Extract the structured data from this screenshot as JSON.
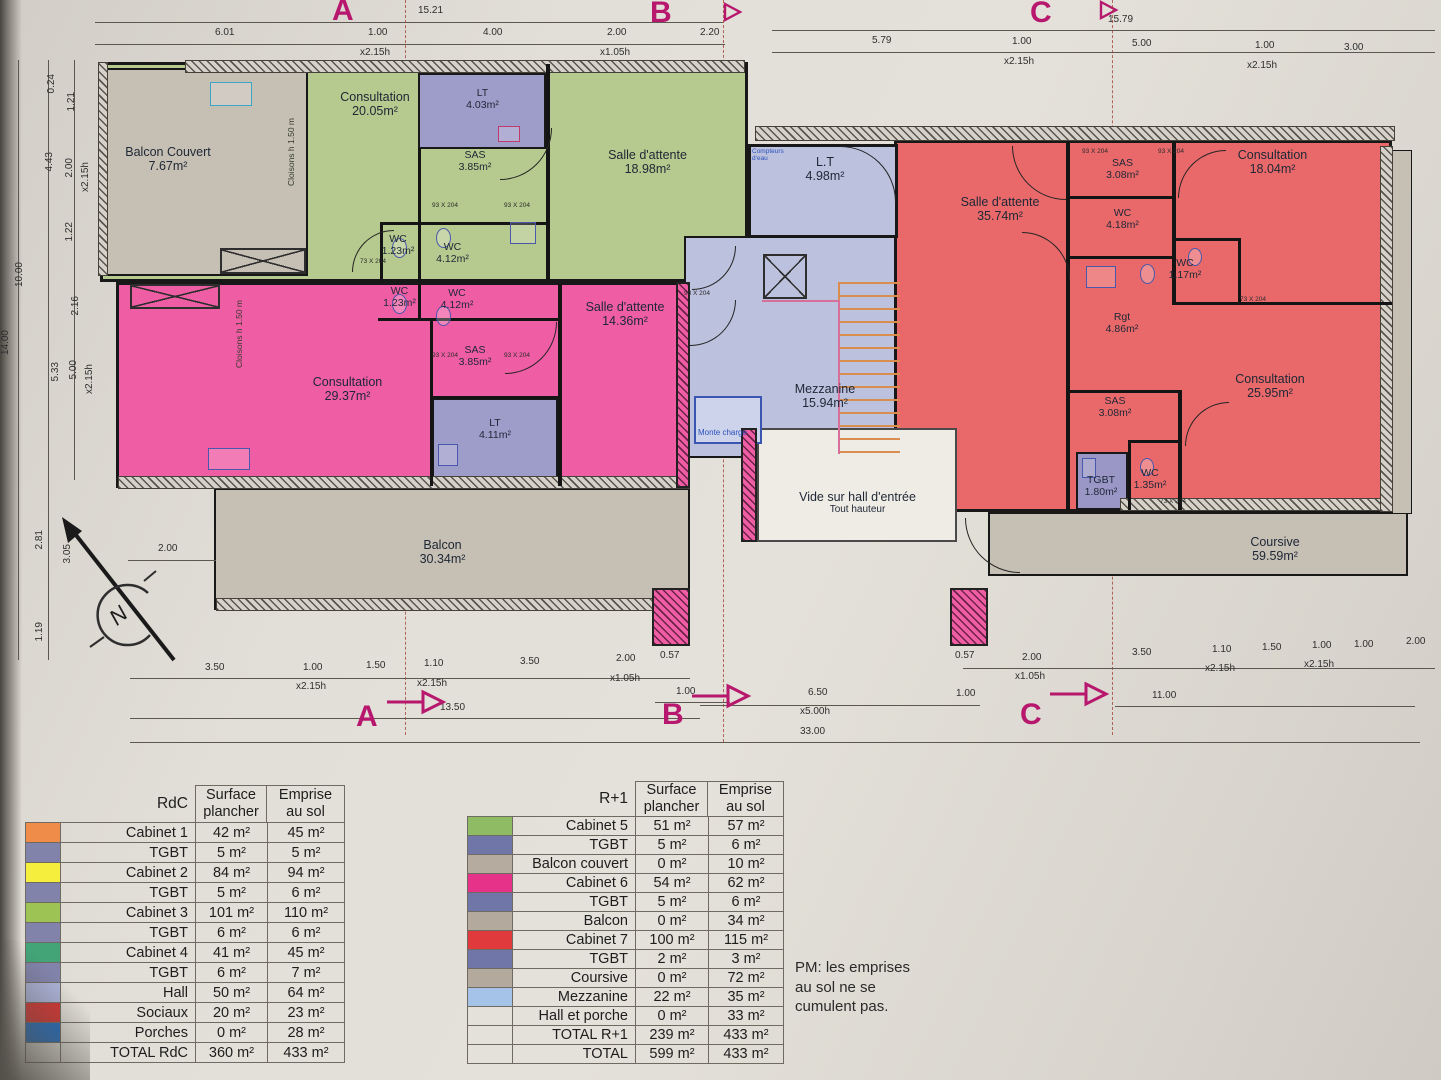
{
  "plan": {
    "sections": {
      "a": "A",
      "b": "B",
      "c": "C"
    },
    "north_label": "N",
    "rooms": [
      {
        "name": "Balcon Couvert",
        "area": "7.67m²"
      },
      {
        "name": "Consultation",
        "area": "20.05m²"
      },
      {
        "name": "LT",
        "area": "4.03m²"
      },
      {
        "name": "SAS",
        "area": "3.85m²"
      },
      {
        "name": "Salle d'attente",
        "area": "18.98m²"
      },
      {
        "name": "WC",
        "area": "1.23m²"
      },
      {
        "name": "WC",
        "area": "4.12m²"
      },
      {
        "name": "WC",
        "area": "1.23m²"
      },
      {
        "name": "WC",
        "area": "4.12m²"
      },
      {
        "name": "SAS",
        "area": "3.85m²"
      },
      {
        "name": "Consultation",
        "area": "29.37m²"
      },
      {
        "name": "LT",
        "area": "4.11m²"
      },
      {
        "name": "Salle d'attente",
        "area": "14.36m²"
      },
      {
        "name": "L.T",
        "area": "4.98m²"
      },
      {
        "name": "Mezzanine",
        "area": "15.94m²"
      },
      {
        "name": "Vide sur hall d'entrée",
        "area": "Tout hauteur"
      },
      {
        "name": "Balcon",
        "area": "30.34m²"
      },
      {
        "name": "Salle d'attente",
        "area": "35.74m²"
      },
      {
        "name": "SAS",
        "area": "3.08m²"
      },
      {
        "name": "WC",
        "area": "4.18m²"
      },
      {
        "name": "Consultation",
        "area": "18.04m²"
      },
      {
        "name": "WC",
        "area": "1.17m²"
      },
      {
        "name": "Rgt",
        "area": "4.86m²"
      },
      {
        "name": "Consultation",
        "area": "25.95m²"
      },
      {
        "name": "SAS",
        "area": "3.08m²"
      },
      {
        "name": "TGBT",
        "area": "1.80m²"
      },
      {
        "name": "WC",
        "area": "1.35m²"
      },
      {
        "name": "Coursive",
        "area": "59.59m²"
      }
    ],
    "labels": {
      "monte_charge": "Monte charge",
      "compteurs": "Compteurs\nd'eau",
      "cloisons": "Cloisons h 1.50 m"
    },
    "door_tags": {
      "d93": "93 X 204",
      "d73": "73 X 204"
    }
  },
  "dims": {
    "top": [
      "15.21",
      "6.01",
      "1.00",
      "x2.15h",
      "4.00",
      "2.00",
      "x1.05h",
      "2.20",
      "15.79",
      "5.79",
      "1.00",
      "x2.15h",
      "5.00",
      "1.00",
      "x2.15h",
      "3.00"
    ],
    "left": [
      "0.24",
      "1.21",
      "4.43",
      "2.00",
      "x2.15h",
      "1.22",
      "10.00",
      "2.16",
      "5.33",
      "5.00",
      "x2.15h",
      "14.00",
      "2.81",
      "3.05",
      "1.19"
    ],
    "bottom": [
      "3.50",
      "1.00",
      "x2.15h",
      "1.50",
      "1.10",
      "x2.15h",
      "3.50",
      "2.00",
      "x1.05h",
      "0.57",
      "1.00",
      "13.50",
      "6.50",
      "x5.00h",
      "0.57",
      "2.00",
      "x1.05h",
      "1.00",
      "3.50",
      "1.10",
      "x2.15h",
      "1.50",
      "1.00",
      "x2.15h",
      "1.00",
      "2.00",
      "11.00",
      "33.00",
      "2.00"
    ]
  },
  "tables": {
    "rdc": {
      "title": "RdC",
      "col_surface": "Surface\nplancher",
      "col_emprise": "Emprise\nau sol",
      "rows": [
        {
          "label": "Cabinet 1",
          "surface": "42 m²",
          "emprise": "45 m²",
          "color": "#ef8c4a"
        },
        {
          "label": "TGBT",
          "surface": "5 m²",
          "emprise": "5 m²",
          "color": "#8183ab"
        },
        {
          "label": "Cabinet 2",
          "surface": "84 m²",
          "emprise": "94 m²",
          "color": "#f6ee3c"
        },
        {
          "label": "TGBT",
          "surface": "5 m²",
          "emprise": "6 m²",
          "color": "#8183ab"
        },
        {
          "label": "Cabinet 3",
          "surface": "101 m²",
          "emprise": "110 m²",
          "color": "#9dc355"
        },
        {
          "label": "TGBT",
          "surface": "6 m²",
          "emprise": "6 m²",
          "color": "#8183ab"
        },
        {
          "label": "Cabinet 4",
          "surface": "41 m²",
          "emprise": "45 m²",
          "color": "#43a478"
        },
        {
          "label": "TGBT",
          "surface": "6 m²",
          "emprise": "7 m²",
          "color": "#8183ab"
        },
        {
          "label": "Hall",
          "surface": "50 m²",
          "emprise": "64 m²",
          "color": "#abb2d8"
        },
        {
          "label": "Sociaux",
          "surface": "20 m²",
          "emprise": "23 m²",
          "color": "#d63331"
        },
        {
          "label": "Porches",
          "surface": "0 m²",
          "emprise": "28 m²",
          "color": "#1e6cc2"
        },
        {
          "label": "TOTAL RdC",
          "surface": "360 m²",
          "emprise": "433 m²",
          "color": null
        }
      ]
    },
    "r1": {
      "title": "R+1",
      "col_surface": "Surface\nplancher",
      "col_emprise": "Emprise\nau sol",
      "rows": [
        {
          "label": "Cabinet 5",
          "surface": "51 m²",
          "emprise": "57 m²",
          "color": "#90bb65"
        },
        {
          "label": "TGBT",
          "surface": "5 m²",
          "emprise": "6 m²",
          "color": "#7176a9"
        },
        {
          "label": "Balcon couvert",
          "surface": "0 m²",
          "emprise": "10 m²",
          "color": "#b5ab9f"
        },
        {
          "label": "Cabinet 6",
          "surface": "54 m²",
          "emprise": "62 m²",
          "color": "#e63289"
        },
        {
          "label": "TGBT",
          "surface": "5 m²",
          "emprise": "6 m²",
          "color": "#7176a9"
        },
        {
          "label": "Balcon",
          "surface": "0 m²",
          "emprise": "34 m²",
          "color": "#b3a99c"
        },
        {
          "label": "Cabinet 7",
          "surface": "100 m²",
          "emprise": "115 m²",
          "color": "#e03a3c"
        },
        {
          "label": "TGBT",
          "surface": "2 m²",
          "emprise": "3 m²",
          "color": "#7176a9"
        },
        {
          "label": "Coursive",
          "surface": "0 m²",
          "emprise": "72 m²",
          "color": "#b3a99c"
        },
        {
          "label": "Mezzanine",
          "surface": "22 m²",
          "emprise": "35 m²",
          "color": "#a5c2e8"
        },
        {
          "label": "Hall et porche",
          "surface": "0 m²",
          "emprise": "33 m²",
          "color": null
        },
        {
          "label": "TOTAL R+1",
          "surface": "239 m²",
          "emprise": "433 m²",
          "color": null
        },
        {
          "label": "TOTAL",
          "surface": "599 m²",
          "emprise": "433 m²",
          "color": null
        }
      ]
    }
  },
  "note": "PM: les emprises\nau sol ne se\ncumulent pas."
}
